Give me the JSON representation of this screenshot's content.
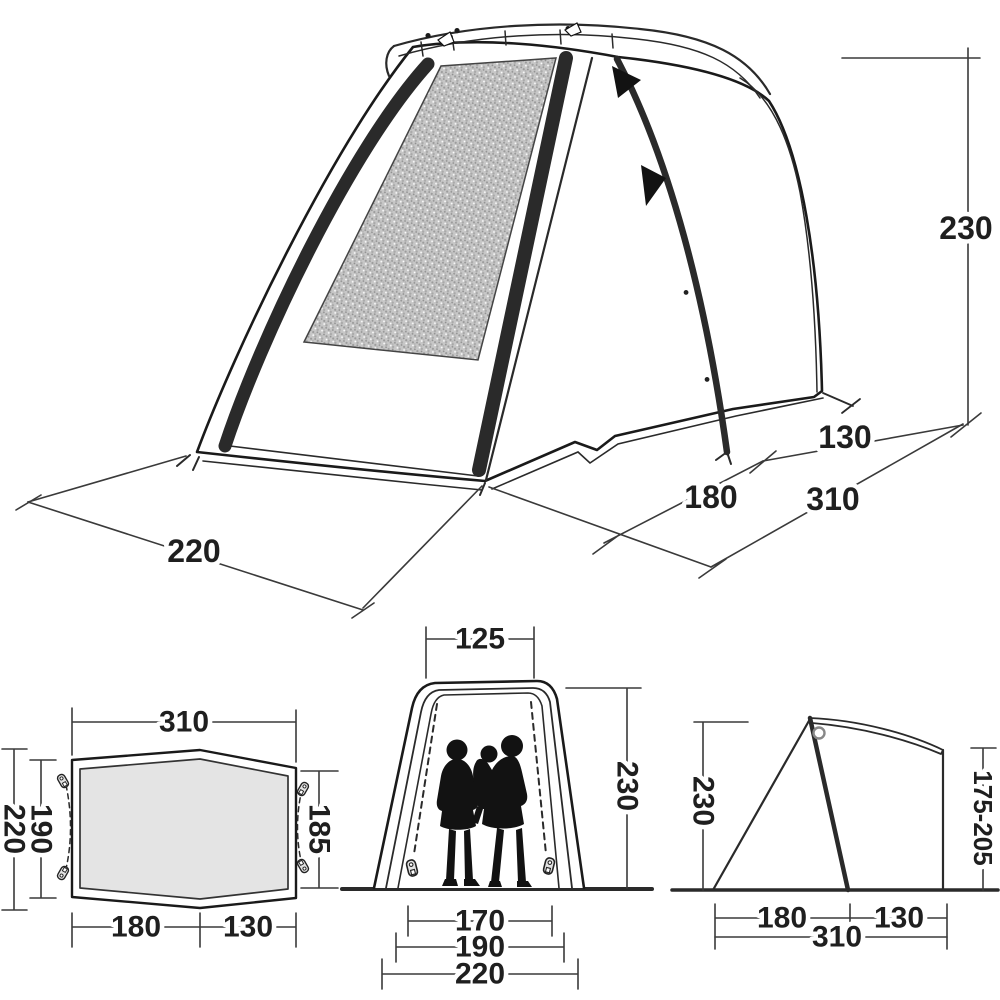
{
  "diagram_title": "tent-dimension-drawing",
  "colors": {
    "line": "#1f1f1f",
    "dimension_line": "#3a3a3a",
    "mesh_fill": "#c7c7c7",
    "floor_fill": "#e4e4e4",
    "silhouette": "#121212",
    "background": "#ffffff"
  },
  "labels": {
    "perspective": {
      "height": "230",
      "rear_depth": "130",
      "front_depth": "180",
      "total_depth": "310",
      "front_width": "220"
    },
    "floor_plan": {
      "top_width": "310",
      "outer_length": "220",
      "inner_length": "190",
      "right_length": "185",
      "front_section": "180",
      "rear_section": "130"
    },
    "front_view": {
      "roof_width": "125",
      "height": "230",
      "inner_width": "170",
      "mid_width": "190",
      "outer_width": "220"
    },
    "side_view": {
      "height": "230",
      "attachment_height": "175-205",
      "front_depth": "180",
      "rear_depth": "130",
      "total_depth": "310"
    }
  }
}
